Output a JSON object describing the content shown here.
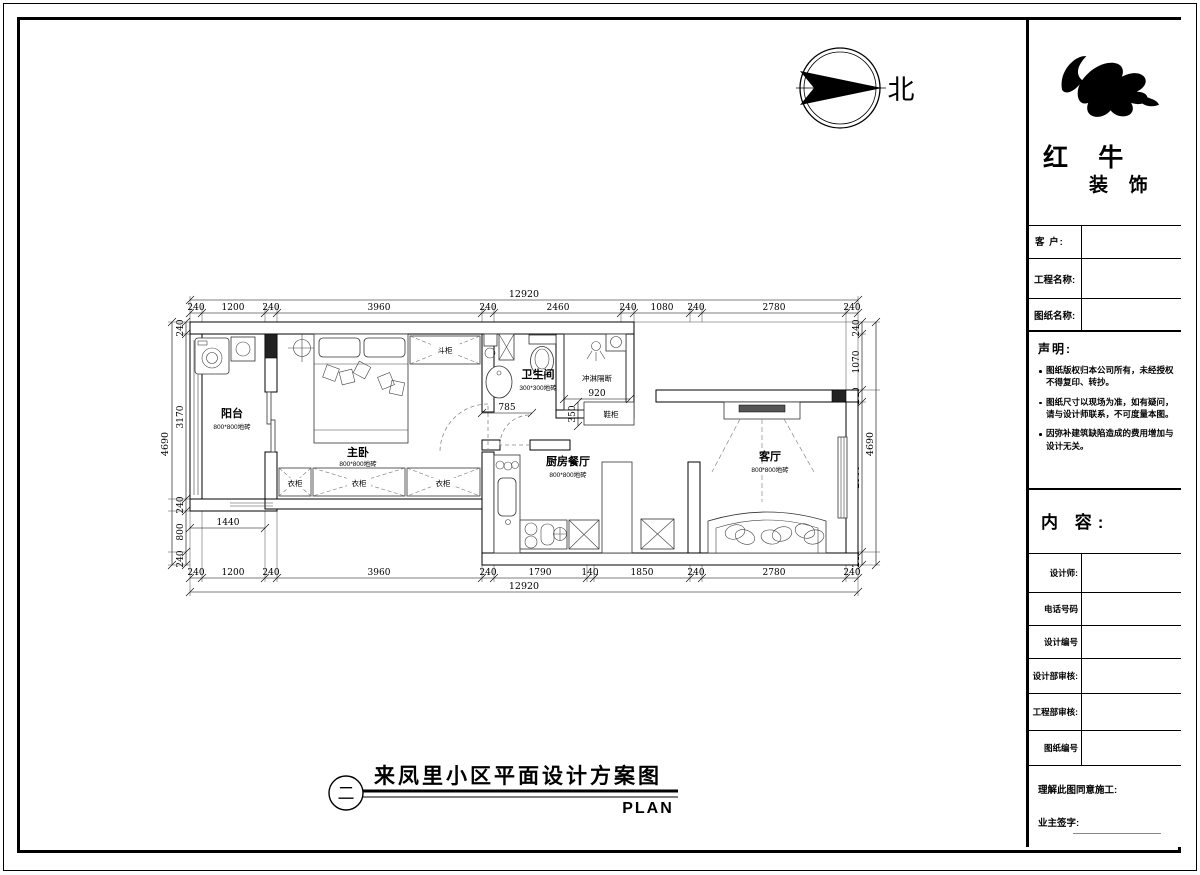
{
  "colors": {
    "ink": "#000000",
    "paper": "#ffffff"
  },
  "north": {
    "label": "北"
  },
  "logo": {
    "line1": "红 牛",
    "line2": "装 饰"
  },
  "titleblock": {
    "customer_label": "客 户:",
    "project_label": "工程名称:",
    "drawing_label": "图纸名称:",
    "statement_title": "声明:",
    "statements": [
      "图纸版权归本公司所有，未经授权不得复印、转抄。",
      "图纸尺寸以现场为准，如有疑问，请与设计师联系，不可度量本图。",
      "因弥补建筑缺陷造成的费用增加与设计无关。"
    ],
    "content_label": "内 容:",
    "designer_label": "设计师:",
    "phone_label": "电话号码",
    "design_no_label": "设计编号",
    "design_dept_label": "设计部审核:",
    "eng_dept_label": "工程部审核:",
    "drawing_no_label": "图纸编号",
    "agree_label": "理解此图同意施工:",
    "sign_label": "业主签字:"
  },
  "plan": {
    "rooms": {
      "balcony": {
        "name": "阳台",
        "tile": "800*800地砖"
      },
      "bedroom": {
        "name": "主卧",
        "tile": "800*800地砖"
      },
      "bathroom": {
        "name": "卫生间",
        "tile": "300*300地砖"
      },
      "kitchen": {
        "name": "厨房餐厅",
        "tile": "800*800地砖"
      },
      "living": {
        "name": "客厅",
        "tile": "800*800地砖"
      }
    },
    "labels": {
      "shower": "冲淋隔断",
      "shower_width": "920",
      "shoe_cabinet": "鞋柜",
      "shoe_depth": "350",
      "dresser": "斗柜",
      "wardrobe": "衣柜",
      "door_width": "785",
      "balcony_width": "1440"
    },
    "dims": {
      "top_total": "12920",
      "top": [
        "240",
        "1200",
        "240",
        "3960",
        "240",
        "2460",
        "240",
        "1080",
        "240",
        "2780",
        "240"
      ],
      "bottom": [
        "240",
        "1200",
        "240",
        "3960",
        "240",
        "1790",
        "140",
        "1850",
        "240",
        "2780",
        "240"
      ],
      "bottom_total": "12920",
      "left": [
        "240",
        "3170",
        "240",
        "800",
        "240"
      ],
      "left_total": "4690",
      "right": [
        "240",
        "1070",
        "240",
        "2900",
        "240"
      ],
      "right_total": "4690"
    }
  },
  "title": {
    "index": "二",
    "main": "来凤里小区平面设计方案图",
    "sub": "PLAN"
  }
}
